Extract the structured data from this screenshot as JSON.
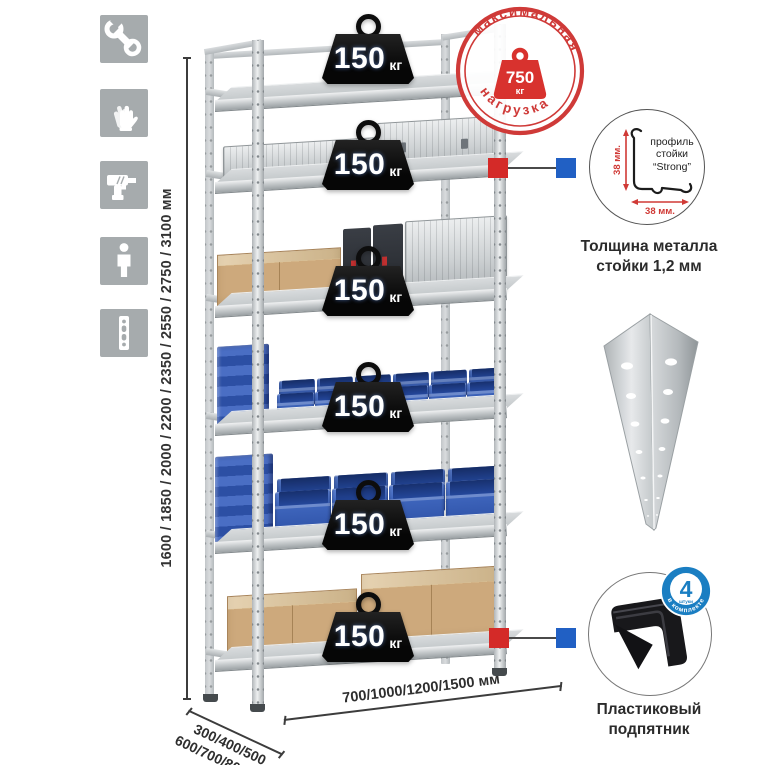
{
  "left_tools": {
    "icons": [
      "wrench",
      "gloves",
      "drill",
      "person",
      "perforated-post"
    ]
  },
  "dimensions": {
    "height": "1600 / 1850 / 2000 / 2200 / 2350 / 2550 / 2750 / 3100 мм",
    "depth_line1": "300/400/500",
    "depth_line2": "600/700/800 мм",
    "width": "700/1000/1200/1500 мм"
  },
  "rack": {
    "shelves_count": 6,
    "shelf_load_value": "150",
    "shelf_load_unit": "кг"
  },
  "stamp": {
    "arc_top": "максимальная",
    "arc_bottom": "нагрузка",
    "weight_value": "750",
    "weight_unit": "кг"
  },
  "profile_detail": {
    "line1": "профиль",
    "line2": "стойки",
    "line3": "“Strong”",
    "dim_vertical": "38 мм.",
    "dim_horizontal": "38 мм.",
    "caption1": "Толщина металла",
    "caption2": "стойки 1,2 мм"
  },
  "foot_detail": {
    "badge_value": "4",
    "badge_sub": "штуки",
    "badge_arc": "в комплекте",
    "caption1": "Пластиковый",
    "caption2": "подпятник"
  },
  "colors": {
    "stamp_red": "#cf3a38",
    "marker_red": "#d42a28",
    "marker_blue": "#2160c4",
    "badge_blue": "#1a7ec2",
    "bin_blue": "#3a62b8",
    "cardboard": "#cda97c",
    "icon_gray": "#a6abad",
    "metal_gray": "#cdd1d3"
  }
}
